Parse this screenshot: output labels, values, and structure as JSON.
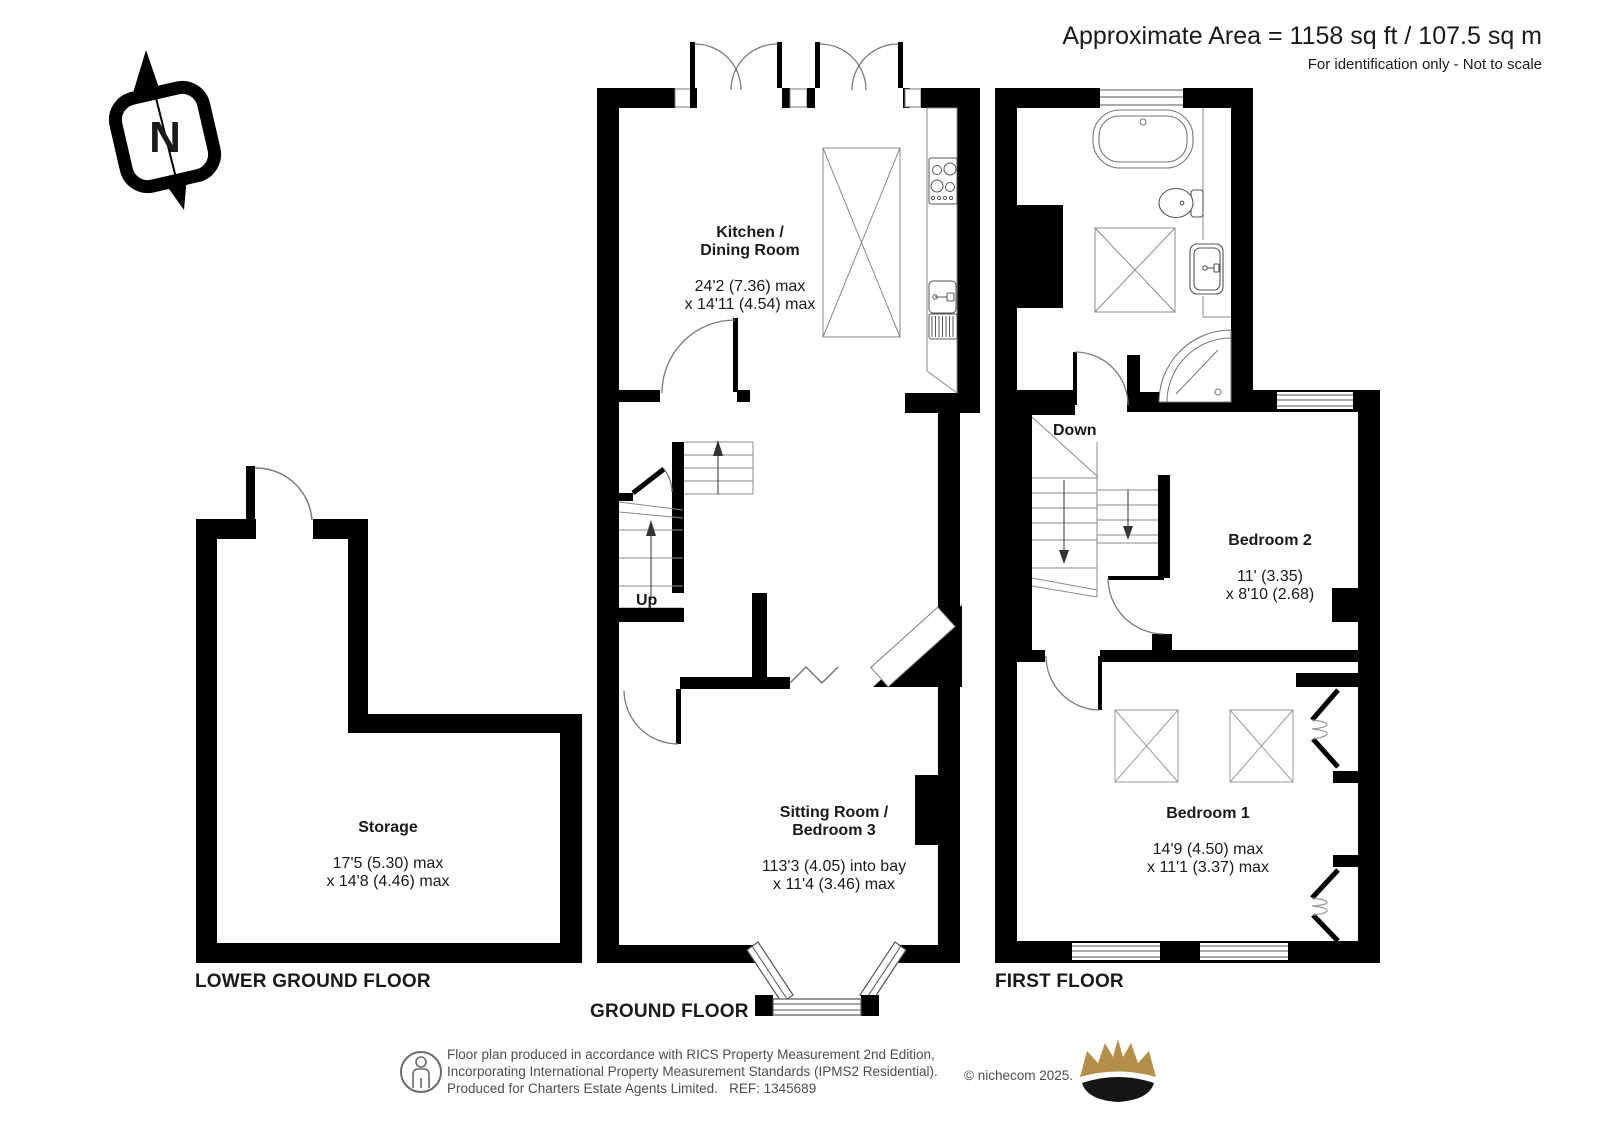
{
  "header": {
    "area_line": "Approximate Area = 1158 sq ft / 107.5 sq m",
    "disclaimer": "For identification only - Not to scale"
  },
  "compass": {
    "label": "N"
  },
  "plans": {
    "lower_ground": {
      "label": "LOWER GROUND FLOOR",
      "rooms": [
        {
          "name": "Storage",
          "dims": "17'5 (5.30) max\nx 14'8 (4.46) max"
        }
      ]
    },
    "ground": {
      "label": "GROUND FLOOR",
      "stair_label": "Up",
      "rooms": [
        {
          "name": "Kitchen /\nDining Room",
          "dims": "24'2 (7.36) max\nx 14'11 (4.54) max"
        },
        {
          "name": "Sitting Room /\nBedroom 3",
          "dims": "113'3 (4.05) into bay\nx 11'4 (3.46) max"
        }
      ]
    },
    "first": {
      "label": "FIRST FLOOR",
      "stair_label": "Down",
      "rooms": [
        {
          "name": "Bedroom 2",
          "dims": "11' (3.35)\nx 8'10 (2.68)"
        },
        {
          "name": "Bedroom 1",
          "dims": "14'9 (4.50) max\nx 11'1 (3.37) max"
        }
      ]
    }
  },
  "footer": {
    "text": "Floor plan produced in accordance with RICS Property Measurement 2nd Edition,\nIncorporating International Property Measurement Standards (IPMS2 Residential).\nProduced for Charters Estate Agents Limited.   REF: 1345689",
    "copyright": "© nichecom 2025."
  },
  "colors": {
    "wall": "#000000",
    "fixture_line": "#7a7a7a",
    "footer_text": "#4d4d4d",
    "crown_gold": "#b3904a"
  }
}
